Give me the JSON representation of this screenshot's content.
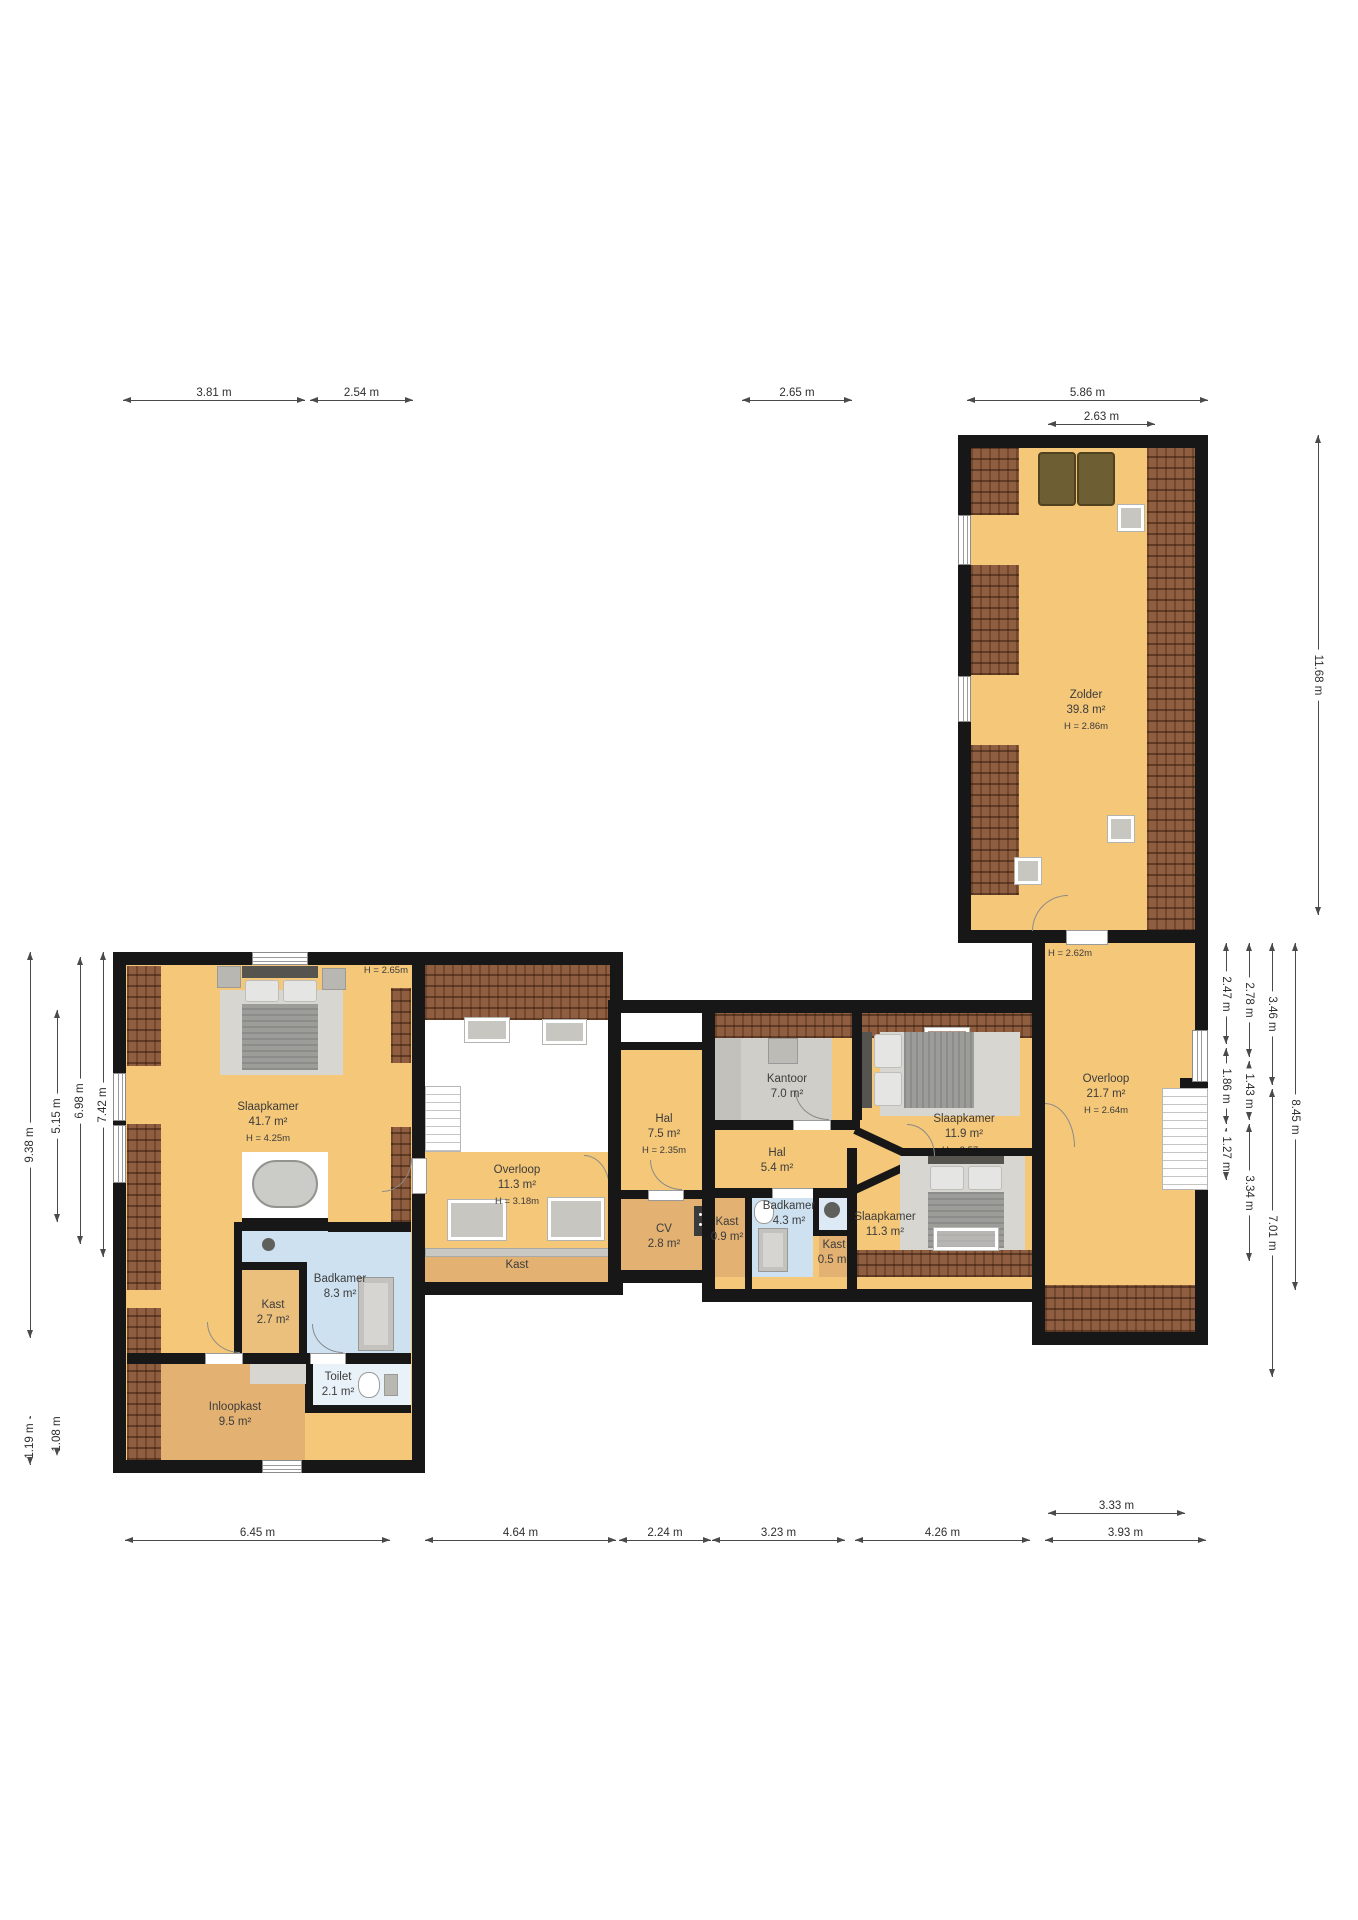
{
  "title": "Floor plan (verdieping)",
  "colors": {
    "floor_amber": "#F5C778",
    "floor_tan": "#E3B172",
    "bathroom_blue": "#CDE1F0",
    "roof_brown": "#8F5E40",
    "wall_black": "#171717",
    "carpet_gray": "#CFCEC9"
  },
  "rooms": {
    "slaapkamer_main": {
      "name": "Slaapkamer",
      "area": "41.7 m²",
      "height": "H = 4.25m"
    },
    "badkamer_main": {
      "name": "Badkamer",
      "area": "8.3 m²"
    },
    "kast_27": {
      "name": "Kast",
      "area": "2.7 m²"
    },
    "inloopkast": {
      "name": "Inloopkast",
      "area": "9.5 m²"
    },
    "toilet": {
      "name": "Toilet",
      "area": "2.1 m²"
    },
    "overloop_mid": {
      "name": "Overloop",
      "area": "11.3 m²",
      "height": "H = 3.18m"
    },
    "kast_strip": {
      "name": "Kast"
    },
    "hal_75": {
      "name": "Hal",
      "area": "7.5 m²",
      "height": "H = 2.35m"
    },
    "cv": {
      "name": "CV",
      "area": "2.8 m²"
    },
    "kantoor": {
      "name": "Kantoor",
      "area": "7.0 m²"
    },
    "hal_54": {
      "name": "Hal",
      "area": "5.4 m²"
    },
    "badkamer_43": {
      "name": "Badkamer",
      "area": "4.3 m²"
    },
    "kast_09": {
      "name": "Kast",
      "area": "0.9 m²"
    },
    "kast_05": {
      "name": "Kast",
      "area": "0.5 m²"
    },
    "slaapkamer_119": {
      "name": "Slaapkamer",
      "area": "11.9 m²",
      "height": "H = 2.57m"
    },
    "slaapkamer_113": {
      "name": "Slaapkamer",
      "area": "11.3 m²"
    },
    "zolder": {
      "name": "Zolder",
      "area": "39.8 m²",
      "height": "H = 2.86m"
    },
    "overloop_right": {
      "name": "Overloop",
      "area": "21.7 m²",
      "height": "H = 2.64m"
    }
  },
  "annotations": {
    "h_left_top": "H = 2.65m",
    "h_zolder_door": "H = 2.62m"
  },
  "dimensions": {
    "top": [
      "3.81 m",
      "2.54 m",
      "2.65 m",
      "5.86 m",
      "2.63 m"
    ],
    "bottom": [
      "6.45 m",
      "4.64 m",
      "2.24 m",
      "3.23 m",
      "4.26 m",
      "3.93 m",
      "3.33 m"
    ],
    "left": [
      "9.38 m",
      "5.15 m",
      "6.98 m",
      "7.42 m",
      "3.33 m",
      "1.19 m",
      "1.08 m"
    ],
    "right": [
      "2.47 m",
      "1.86 m",
      "1.27 m",
      "2.78 m",
      "1.43 m",
      "3.34 m",
      "3.46 m",
      "7.01 m",
      "8.45 m",
      "11.68 m"
    ]
  }
}
